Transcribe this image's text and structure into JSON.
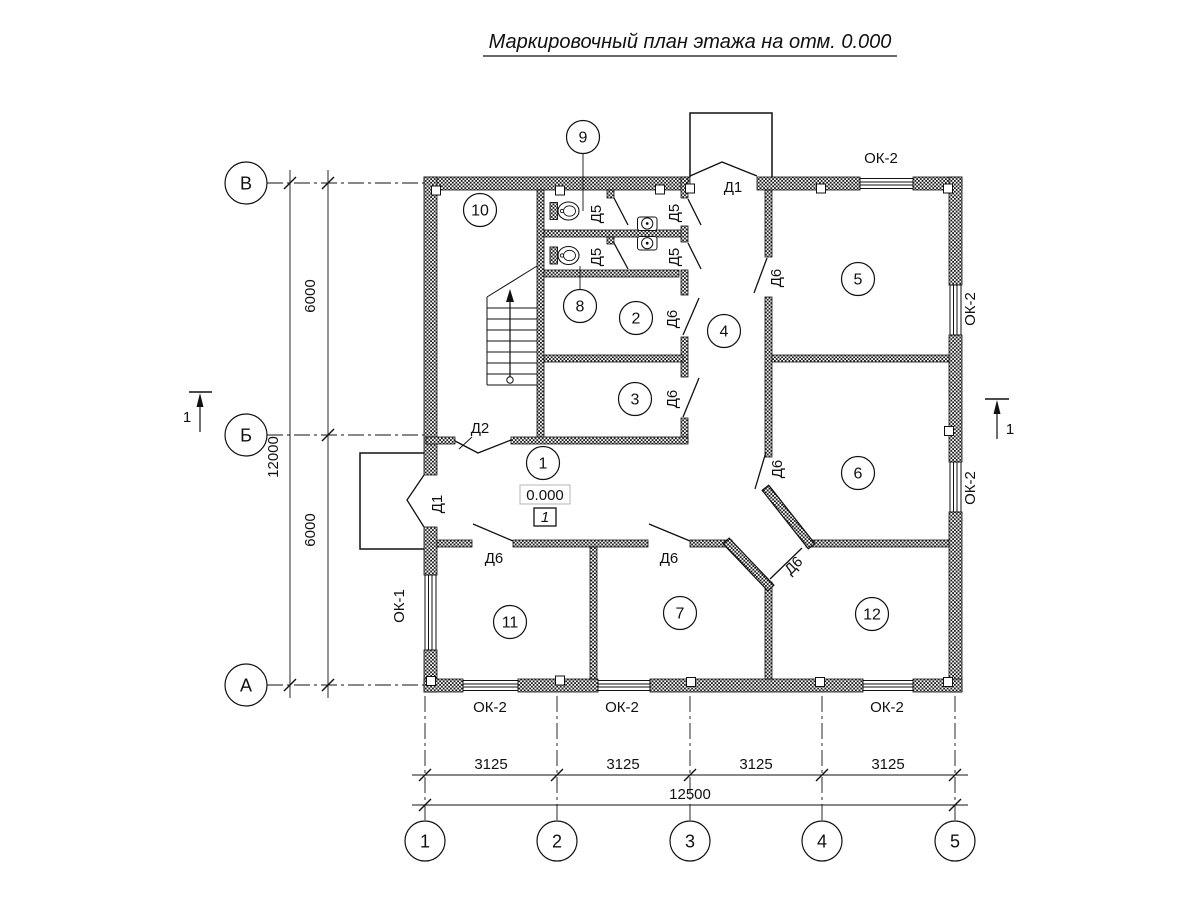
{
  "title": "Маркировочный план этажа на отм. 0.000",
  "axes": {
    "v": [
      "В",
      "Б",
      "А"
    ],
    "h": [
      "1",
      "2",
      "3",
      "4",
      "5"
    ]
  },
  "dims": {
    "left_upper": "6000",
    "left_total": "12000",
    "left_lower": "6000",
    "segments": [
      "3125",
      "3125",
      "3125",
      "3125"
    ],
    "total": "12500"
  },
  "rooms": {
    "n1": "1",
    "n2": "2",
    "n3": "3",
    "n4": "4",
    "n5": "5",
    "n6": "6",
    "n7": "7",
    "n8": "8",
    "n9": "9",
    "n10": "10",
    "n11": "11",
    "n12": "12"
  },
  "doors": {
    "d1": "Д1",
    "d2": "Д2",
    "d5": "Д5",
    "d6": "Д6"
  },
  "windows": {
    "ok1": "ОК-1",
    "ok2": "ОК-2"
  },
  "elevation": {
    "value": "0.000",
    "floor": "1"
  },
  "section": {
    "label": "1"
  }
}
